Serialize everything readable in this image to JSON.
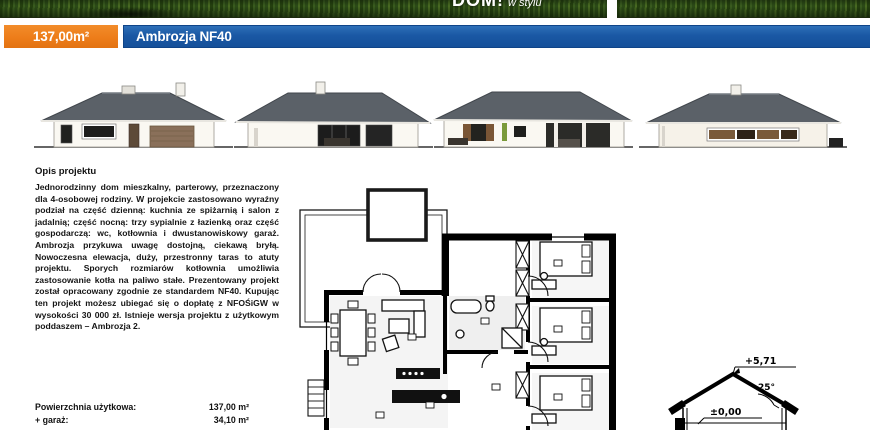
{
  "header": {
    "logo": {
      "primary": "DOM!",
      "secondary": "w stylu"
    },
    "area_badge": "137,00m²",
    "project_name": "Ambrozja NF40"
  },
  "colors": {
    "accent_orange": "#ED7D1A",
    "accent_blue": "#1A58A4",
    "roof_gray": "#5b6168",
    "wall_cream": "#faf8f2",
    "wood_brown": "#8a705a"
  },
  "elevations": {
    "items": [
      {
        "name": "front-elevation-with-garage"
      },
      {
        "name": "side-elevation-terrace"
      },
      {
        "name": "garden-elevation"
      },
      {
        "name": "side-elevation-window-band"
      }
    ]
  },
  "description": {
    "heading": "Opis projektu",
    "body": "Jednorodzinny dom mieszkalny, parterowy, przeznaczony dla 4-osobowej rodziny. W projekcie zastosowano wyraźny podział na część dzienną: kuchnia ze spiżarnią i salon z jadalnią; część nocną: trzy sypialnie z łazienką oraz część gospodarczą: wc, kotłownia i dwustanowiskowy garaż. Ambrozja przykuwa uwagę dostojną, ciekawą bryłą. Nowoczesna elewacja, duży, przestronny taras to atuty projektu. Sporych rozmiarów kotłownia umożliwia zastosowanie kotła na paliwo stałe. Prezentowany projekt został opracowany zgodnie ze standardem NF40. Kupując ten projekt możesz ubiegać się o dopłatę z NFOŚiGW w wysokości 30 000 zł. Istnieje wersja projektu z użytkowym poddaszem – Ambrozja 2."
  },
  "specs": {
    "rows": [
      {
        "label": "Powierzchnia użytkowa:",
        "value": "137,00 m²"
      },
      {
        "label": "+ garaż:",
        "value": "34,10 m²"
      }
    ]
  },
  "section_drawing": {
    "ridge_level": "+5,71",
    "roof_angle": "25°",
    "ground_level": "±0,00"
  }
}
